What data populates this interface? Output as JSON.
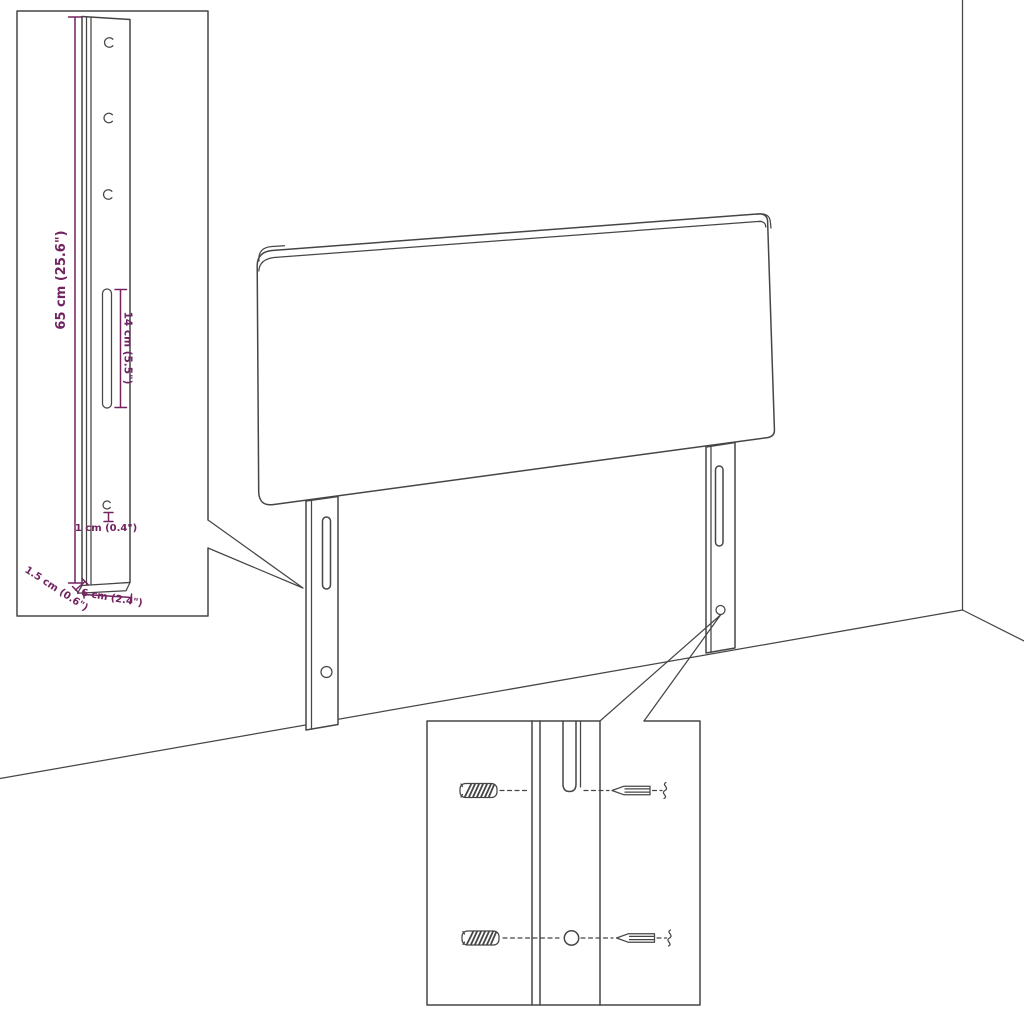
{
  "diagram": {
    "kind": "product-dimension-line-drawing",
    "colors": {
      "background": "#ffffff",
      "outline": "#464646",
      "dimension": "#722360"
    },
    "bracket_callout": {
      "labels": {
        "height": "65 cm (25.6\")",
        "slot_length": "14 cm (5.5\")",
        "bottom_hole": "1 cm (0.4\")",
        "depth": "1.5 cm (0.6\")",
        "width": "6 cm (2.4\")"
      }
    },
    "hardware_callout": {
      "parts": [
        "wall-plug",
        "mounting-slot",
        "mounting-hole",
        "screw"
      ]
    }
  }
}
